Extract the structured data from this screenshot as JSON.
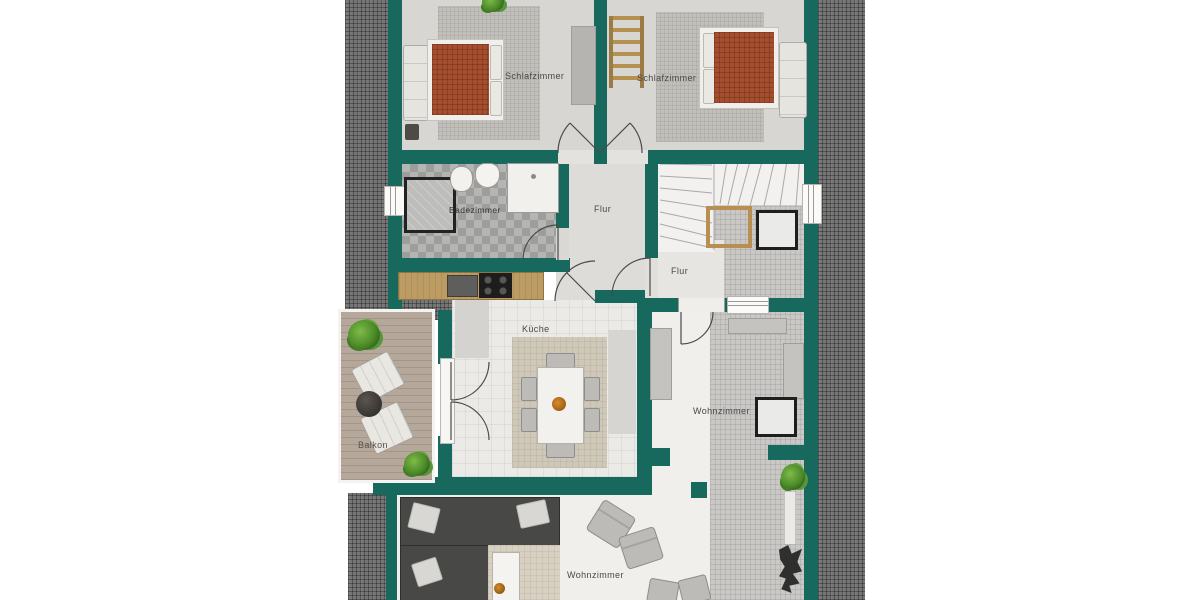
{
  "title": "Grundriss Dachgeschoss",
  "language": "de",
  "rooms": {
    "bedroomLeft": {
      "label": "Schlafzimmer"
    },
    "bedroomRight": {
      "label": "Schlafzimmer"
    },
    "bathroom": {
      "label": "Badezimmer"
    },
    "hallMain": {
      "label": "Flur"
    },
    "hallSecond": {
      "label": "Flur"
    },
    "kitchen": {
      "label": "Küche"
    },
    "balcony": {
      "label": "Balkon"
    },
    "livingRight": {
      "label": "Wohnzimmer"
    },
    "livingBottom": {
      "label": "Wohnzimmer"
    }
  },
  "palette": {
    "wall_teal": "#17695d",
    "roof_hatch_gray": "#767676",
    "bed_terracotta": "#a64d2d",
    "wood_counter": "#bd9c63",
    "deck_wood": "#b5a89b",
    "floor_light": "#eceae6",
    "floor_tile": "#c9c8c5",
    "label_text": "#474848"
  },
  "icons": {
    "plants": 4,
    "beds": 2,
    "doors": 8,
    "windows": 3,
    "staircase": 1,
    "ladder": 1
  }
}
